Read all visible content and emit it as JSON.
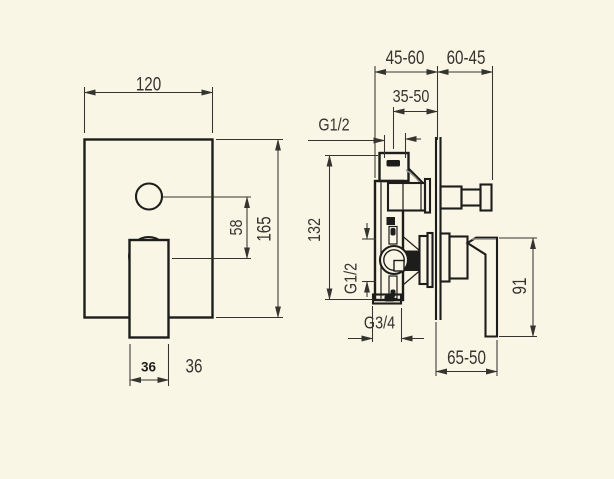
{
  "drawing": {
    "kind": "technical dimension drawing",
    "subject": "concealed single-lever shower mixer with diverter, front view and side section view"
  },
  "labels": {
    "plate_width": "120",
    "plate_height": "165",
    "button_offset": "58",
    "handle_width": "36",
    "handle_width_dup": "36",
    "depth_range": "45-60",
    "projection_range": "60-45",
    "rough_in_range": "35-50",
    "top_outlet_thread": "G1/2",
    "body_height": "132",
    "inlet_thread": "G1/2",
    "bottom_outlet_thread": "G3/4",
    "handle_depth_range": "65-50",
    "handle_length": "91"
  },
  "colors": {
    "bg": "#faf6e6",
    "ink": "#1d1d1b",
    "dim": "#35342f",
    "grey": "#97948c"
  }
}
